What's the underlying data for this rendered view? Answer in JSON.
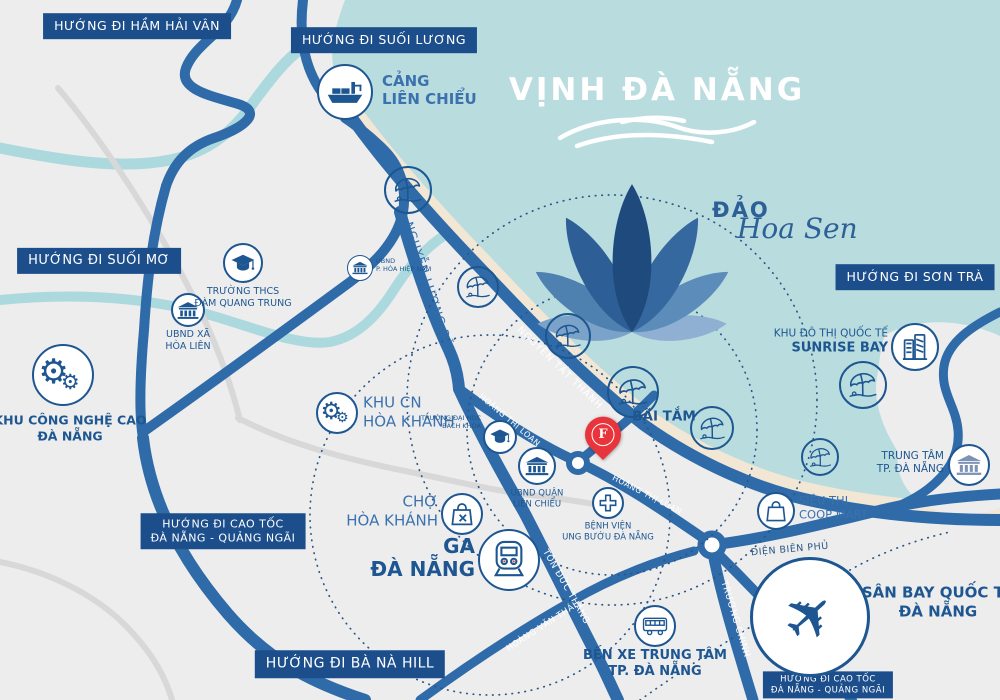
{
  "sea": {
    "title": "VỊNH ĐÀ NẴNG"
  },
  "island": {
    "caps": "ĐẢO",
    "script": "Hoa Sen"
  },
  "badges": {
    "ham_hai_van": "HƯỚNG ĐI HẦM HẢI VÂN",
    "suoi_luong": "HƯỚNG ĐI SUỐI LƯƠNG",
    "suoi_mo": "HƯỚNG ĐI SUỐI MƠ",
    "son_tra": "HƯỚNG ĐI SƠN TRÀ",
    "cao_toc_1": "HƯỚNG ĐI CAO TỐC",
    "cao_toc_2": "ĐÀ NẴNG - QUẢNG NGÃI",
    "ba_na": "HƯỚNG ĐI BÀ NÀ HILL"
  },
  "roads": {
    "nguyen_luong_bang": "NGUYỄN LƯƠNG BẰNG",
    "nguyen_tat_thanh": "NGUYỄN TẤT THÀNH",
    "hoang_thi_loan": "HOÀNG THỊ LOAN",
    "ton_duc_thang": "TÔN ĐỨC THẮNG",
    "hoang_van_thai": "HOÀNG VĂN THÁI",
    "truong_chinh": "TRƯỜNG CHINH",
    "dien_bien_phu": "ĐIỆN BIÊN PHỦ"
  },
  "pois": {
    "cang_lien_chieu": {
      "l1": "CẢNG",
      "l2": "LIÊN CHIỂU"
    },
    "truong_thcs": {
      "l1": "TRƯỜNG THCS",
      "l2": "ĐÀM QUANG TRUNG"
    },
    "ubnd_xa_hoa_lien": {
      "l1": "UBND XÃ",
      "l2": "HÒA LIÊN"
    },
    "ubnd_hoa_hiep_nam": {
      "l1": "UBND",
      "l2": "P. HÒA HIỆP NAM"
    },
    "khu_cong_nghe_cao": {
      "l1": "KHU CÔNG NGHỆ CAO",
      "l2": "ĐÀ NẴNG"
    },
    "khu_cn_hoa_khanh": {
      "l1": "KHU CN",
      "l2": "HÒA KHÁNH"
    },
    "bai_tam": {
      "l1": "BÃI TẮM"
    },
    "sunrise_bay": {
      "l1": "KHU ĐÔ THỊ QUỐC TẾ",
      "l2": "SUNRISE BAY"
    },
    "trung_tam_tp": {
      "l1": "TRUNG TÂM",
      "l2": "TP. ĐÀ NẴNG"
    },
    "coop_mart": {
      "l1": "SIÊU THỊ",
      "l2": "COOP MART"
    },
    "truong_dai_hoc": {
      "l1": "TRƯỜNG ĐẠI HỌC",
      "l2": "BÁCH KHOA"
    },
    "ubnd_quan_lien_chieu": {
      "l1": "UBND QUẬN",
      "l2": "LIÊN CHIỂU"
    },
    "benh_vien": {
      "l1": "BỆNH VIỆN",
      "l2": "UNG BƯỚU ĐÀ NẴNG"
    },
    "cho_hoa_khanh": {
      "l1": "CHỢ",
      "l2": "HÒA KHÁNH"
    },
    "ga_da_nang": {
      "l1": "GA",
      "l2": "ĐÀ NẴNG"
    },
    "ben_xe": {
      "l1": "BẾN XE TRUNG TÂM",
      "l2": "TP. ĐÀ NẴNG"
    },
    "san_bay": {
      "l1": "SÂN BAY QUỐC TẾ",
      "l2": "ĐÀ NẴNG"
    }
  },
  "marker": {
    "letter": "F"
  },
  "icons": {
    "gear": "⚙",
    "plane": "✈"
  },
  "colors": {
    "sea": "#b9dcdf",
    "land": "#ededee",
    "sand": "#f2e6d5",
    "road_blue": "#2e6ba8",
    "badge_navy": "#1d4e8c",
    "poi_navy": "#1d5691",
    "river": "#abd9dd",
    "marker_red": "#e8353c",
    "lotus_dark": "#1f4a7d"
  }
}
